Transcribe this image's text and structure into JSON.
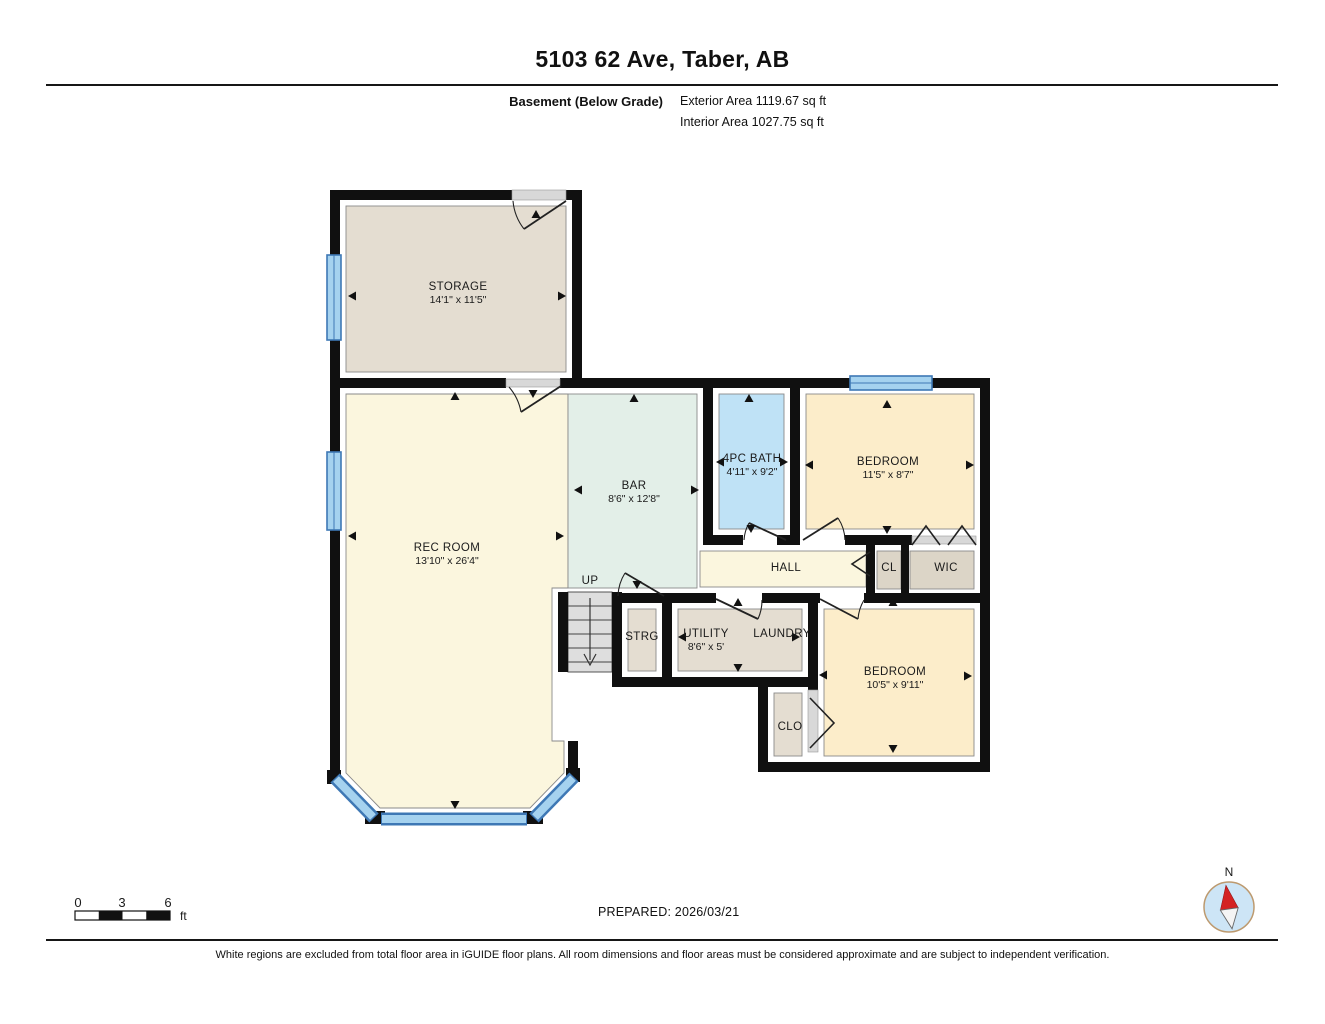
{
  "header": {
    "title": "5103 62 Ave, Taber, AB",
    "floor_label": "Basement (Below Grade)",
    "exterior_area": "Exterior Area 1119.67 sq ft",
    "interior_area": "Interior Area 1027.75 sq ft"
  },
  "plan": {
    "rooms": {
      "storage": {
        "label": "STORAGE",
        "dims": "14'1\" x 11'5\""
      },
      "rec_room": {
        "label": "REC ROOM",
        "dims": "13'10\" x 26'4\""
      },
      "bar": {
        "label": "BAR",
        "dims": "8'6\" x 12'8\""
      },
      "bath": {
        "label": "4PC BATH",
        "dims": "4'11\" x 9'2\""
      },
      "bedroom1": {
        "label": "BEDROOM",
        "dims": "11'5\" x 8'7\""
      },
      "hall": {
        "label": "HALL"
      },
      "cl": {
        "label": "CL"
      },
      "wic": {
        "label": "WIC"
      },
      "stairs": {
        "label": "UP"
      },
      "strg": {
        "label": "STRG"
      },
      "utility": {
        "label": "UTILITY",
        "dims": "8'6\" x 5'"
      },
      "laundry": {
        "label": "LAUNDRY"
      },
      "bedroom2": {
        "label": "BEDROOM",
        "dims": "10'5\" x 9'11\""
      },
      "clo": {
        "label": "CLO"
      }
    },
    "colors": {
      "wall": "#101010",
      "window_fill": "#a5d2ef",
      "window_edge": "#3e78b5",
      "room_beige": "#e4ddd1",
      "room_cream": "#fbf6de",
      "room_mint": "#e3efe8",
      "room_blue": "#bfe2f6",
      "room_peach": "#fcedca",
      "room_taupe": "#dcd5c7",
      "stairs_gray": "#dedede",
      "door_gap_gray": "#d8d8d8"
    }
  },
  "footer": {
    "scale_ticks": [
      "0",
      "3",
      "6"
    ],
    "scale_unit": "ft",
    "prepared": "PREPARED: 2026/03/21",
    "compass_north": "N",
    "disclaimer": "White regions are excluded from total floor area in iGUIDE floor plans. All room dimensions and floor areas must be considered approximate and are subject to independent verification."
  }
}
